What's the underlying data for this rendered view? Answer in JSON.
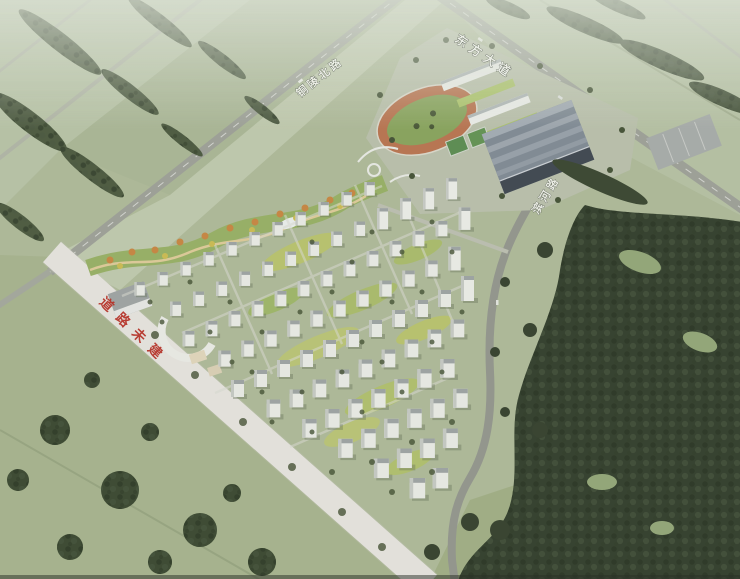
{
  "labels": {
    "road_north": "铜陵北路",
    "road_avenue": "东方大道",
    "road_east": "滨河路",
    "road_unbuilt_note": "道路未建"
  },
  "colors": {
    "note_red": "#b5342a",
    "road_label_white": "#eff1ea",
    "unbuilt_road_white": "#ecebe6",
    "asphalt_gray": "#999d94",
    "field_green": "#aab695",
    "forest_dark": "#2c3826",
    "track_orange": "#b56f4b",
    "infield_green": "#84a058",
    "court_green": "#55884c",
    "gym_roof_gray": "#7b8691",
    "courtyard_yellow_green": "#b7c262",
    "autumn_tree_orange": "#c4823c"
  }
}
